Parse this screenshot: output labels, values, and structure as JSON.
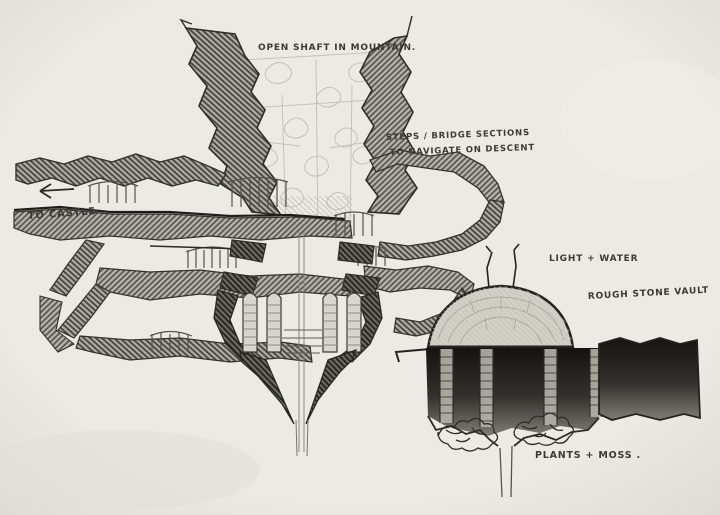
{
  "meta": {
    "title": "Hand-drawn pencil concept sketch of an underground shaft, switchback tunnels and a stone vault",
    "medium": "pencil on paper"
  },
  "colors": {
    "paper": "#e9e7e1",
    "ink": "#2b2a27",
    "hatch_dark": "#46443f",
    "hatch_mid": "#504e49",
    "faint_pencil": "#c5c2b9"
  },
  "annotations": {
    "open_shaft": "OPEN SHAFT IN MOUNTAIN.",
    "steps_line1": "STEPS / BRIDGE SECTIONS",
    "steps_line2": "TO NAVIGATE ON DESCENT",
    "to_castle": "TO CASTLE",
    "light_water": "LIGHT + WATER",
    "rough_stone_vault": "ROUGH STONE VAULT",
    "plants_moss": "PLANTS + MOSS ."
  },
  "icons": {
    "to_castle_arrow": "left-arrow"
  }
}
